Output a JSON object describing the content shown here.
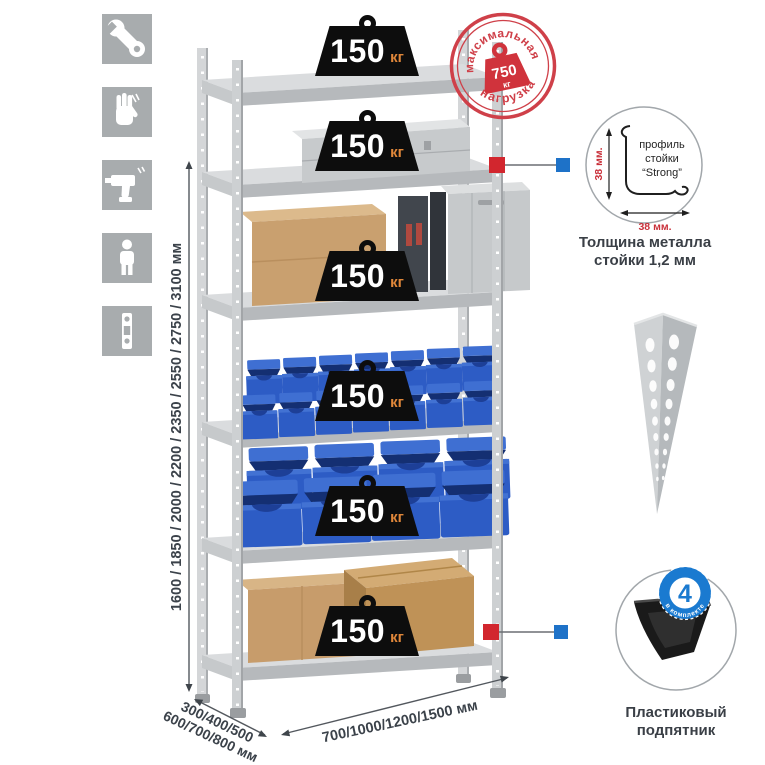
{
  "tool_icons": [
    {
      "name": "wrench"
    },
    {
      "name": "gloves"
    },
    {
      "name": "drill"
    },
    {
      "name": "person"
    },
    {
      "name": "level"
    }
  ],
  "dimensions": {
    "height_label": "1600 / 1850 / 2000 / 2200 / 2350 / 2550 / 2750 / 3100 мм",
    "depth_label_line1": "300/400/500",
    "depth_label_line2": "600/700/800 мм",
    "width_label": "700/1000/1200/1500 мм"
  },
  "shelf_load_badge": {
    "value": "150",
    "unit": "кг"
  },
  "max_load_stamp": {
    "arc_top": "максимальная",
    "arc_bottom": "нагрузка",
    "value": "750",
    "unit": "кг"
  },
  "profile_detail": {
    "line1": "профиль",
    "line2": "стойки",
    "line3": "“Strong”",
    "dim_vertical": "38 мм.",
    "dim_horizontal": "38 мм.",
    "caption_line1": "Толщина металла",
    "caption_line2": "стойки 1,2 мм"
  },
  "foot_detail": {
    "badge_value": "4",
    "badge_arc": "в комплекте",
    "caption_line1": "Пластиковый",
    "caption_line2": "подпятник"
  },
  "colors": {
    "stamp_red": "#cf4049",
    "accent_red_square": "#d2262e",
    "accent_blue_square": "#1e72c8",
    "badge_black": "#0d0d0d",
    "badge_unit_orange": "#e0873a",
    "bin_blue": "#2d5cc5",
    "metal_gray": "#cdd0d2",
    "dimension_text": "#3b424a"
  }
}
